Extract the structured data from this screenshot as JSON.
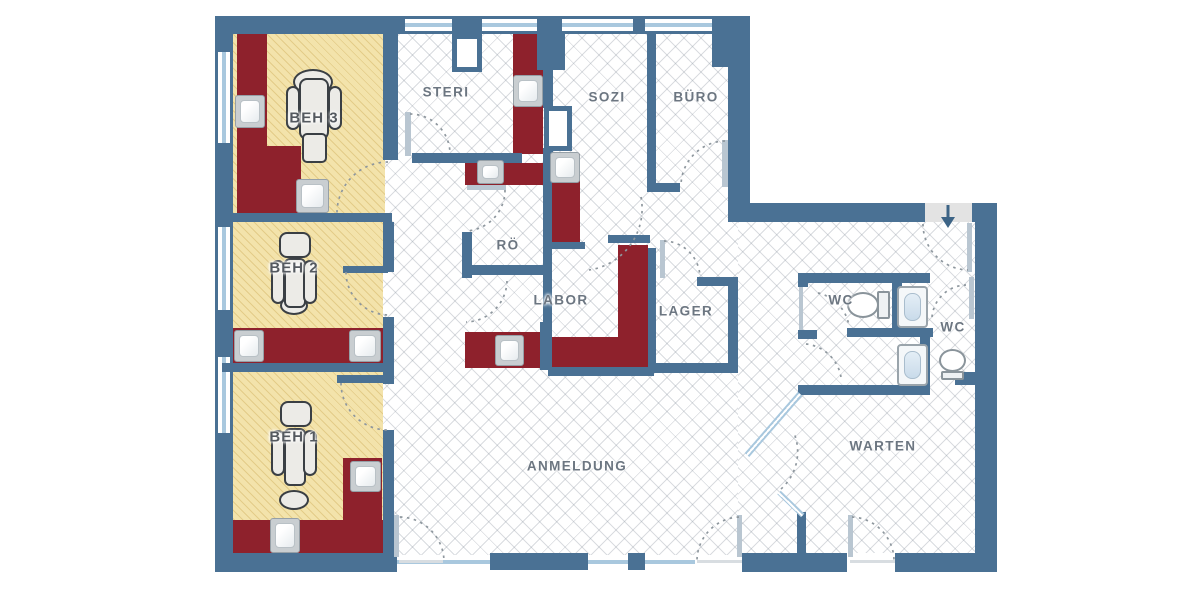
{
  "plan": {
    "title": "practice-floor-plan",
    "rooms": {
      "beh3": "BEH 3",
      "beh2": "BEH 2",
      "beh1": "BEH 1",
      "steri": "STERI",
      "sozi": "SOZI",
      "buero": "BÜRO",
      "roe": "RÖ",
      "labor": "LABOR",
      "lager": "LAGER",
      "wc_left": "WC",
      "wc_right": "WC",
      "warten": "WARTEN",
      "anmeldung": "ANMELDUNG"
    },
    "colors": {
      "wall": "#4a7194",
      "cabinet": "#8e212c",
      "treatment_room_fill": "#f3e3ab",
      "window_glass": "#a9c8de",
      "entrance_marker": "#e3e3e3",
      "label_text": "#6c7681"
    },
    "fixtures": {
      "dental_chairs": 3,
      "sinks": 10,
      "wash_basins": 2,
      "toilets": 2,
      "entrance_arrow": "down"
    }
  }
}
